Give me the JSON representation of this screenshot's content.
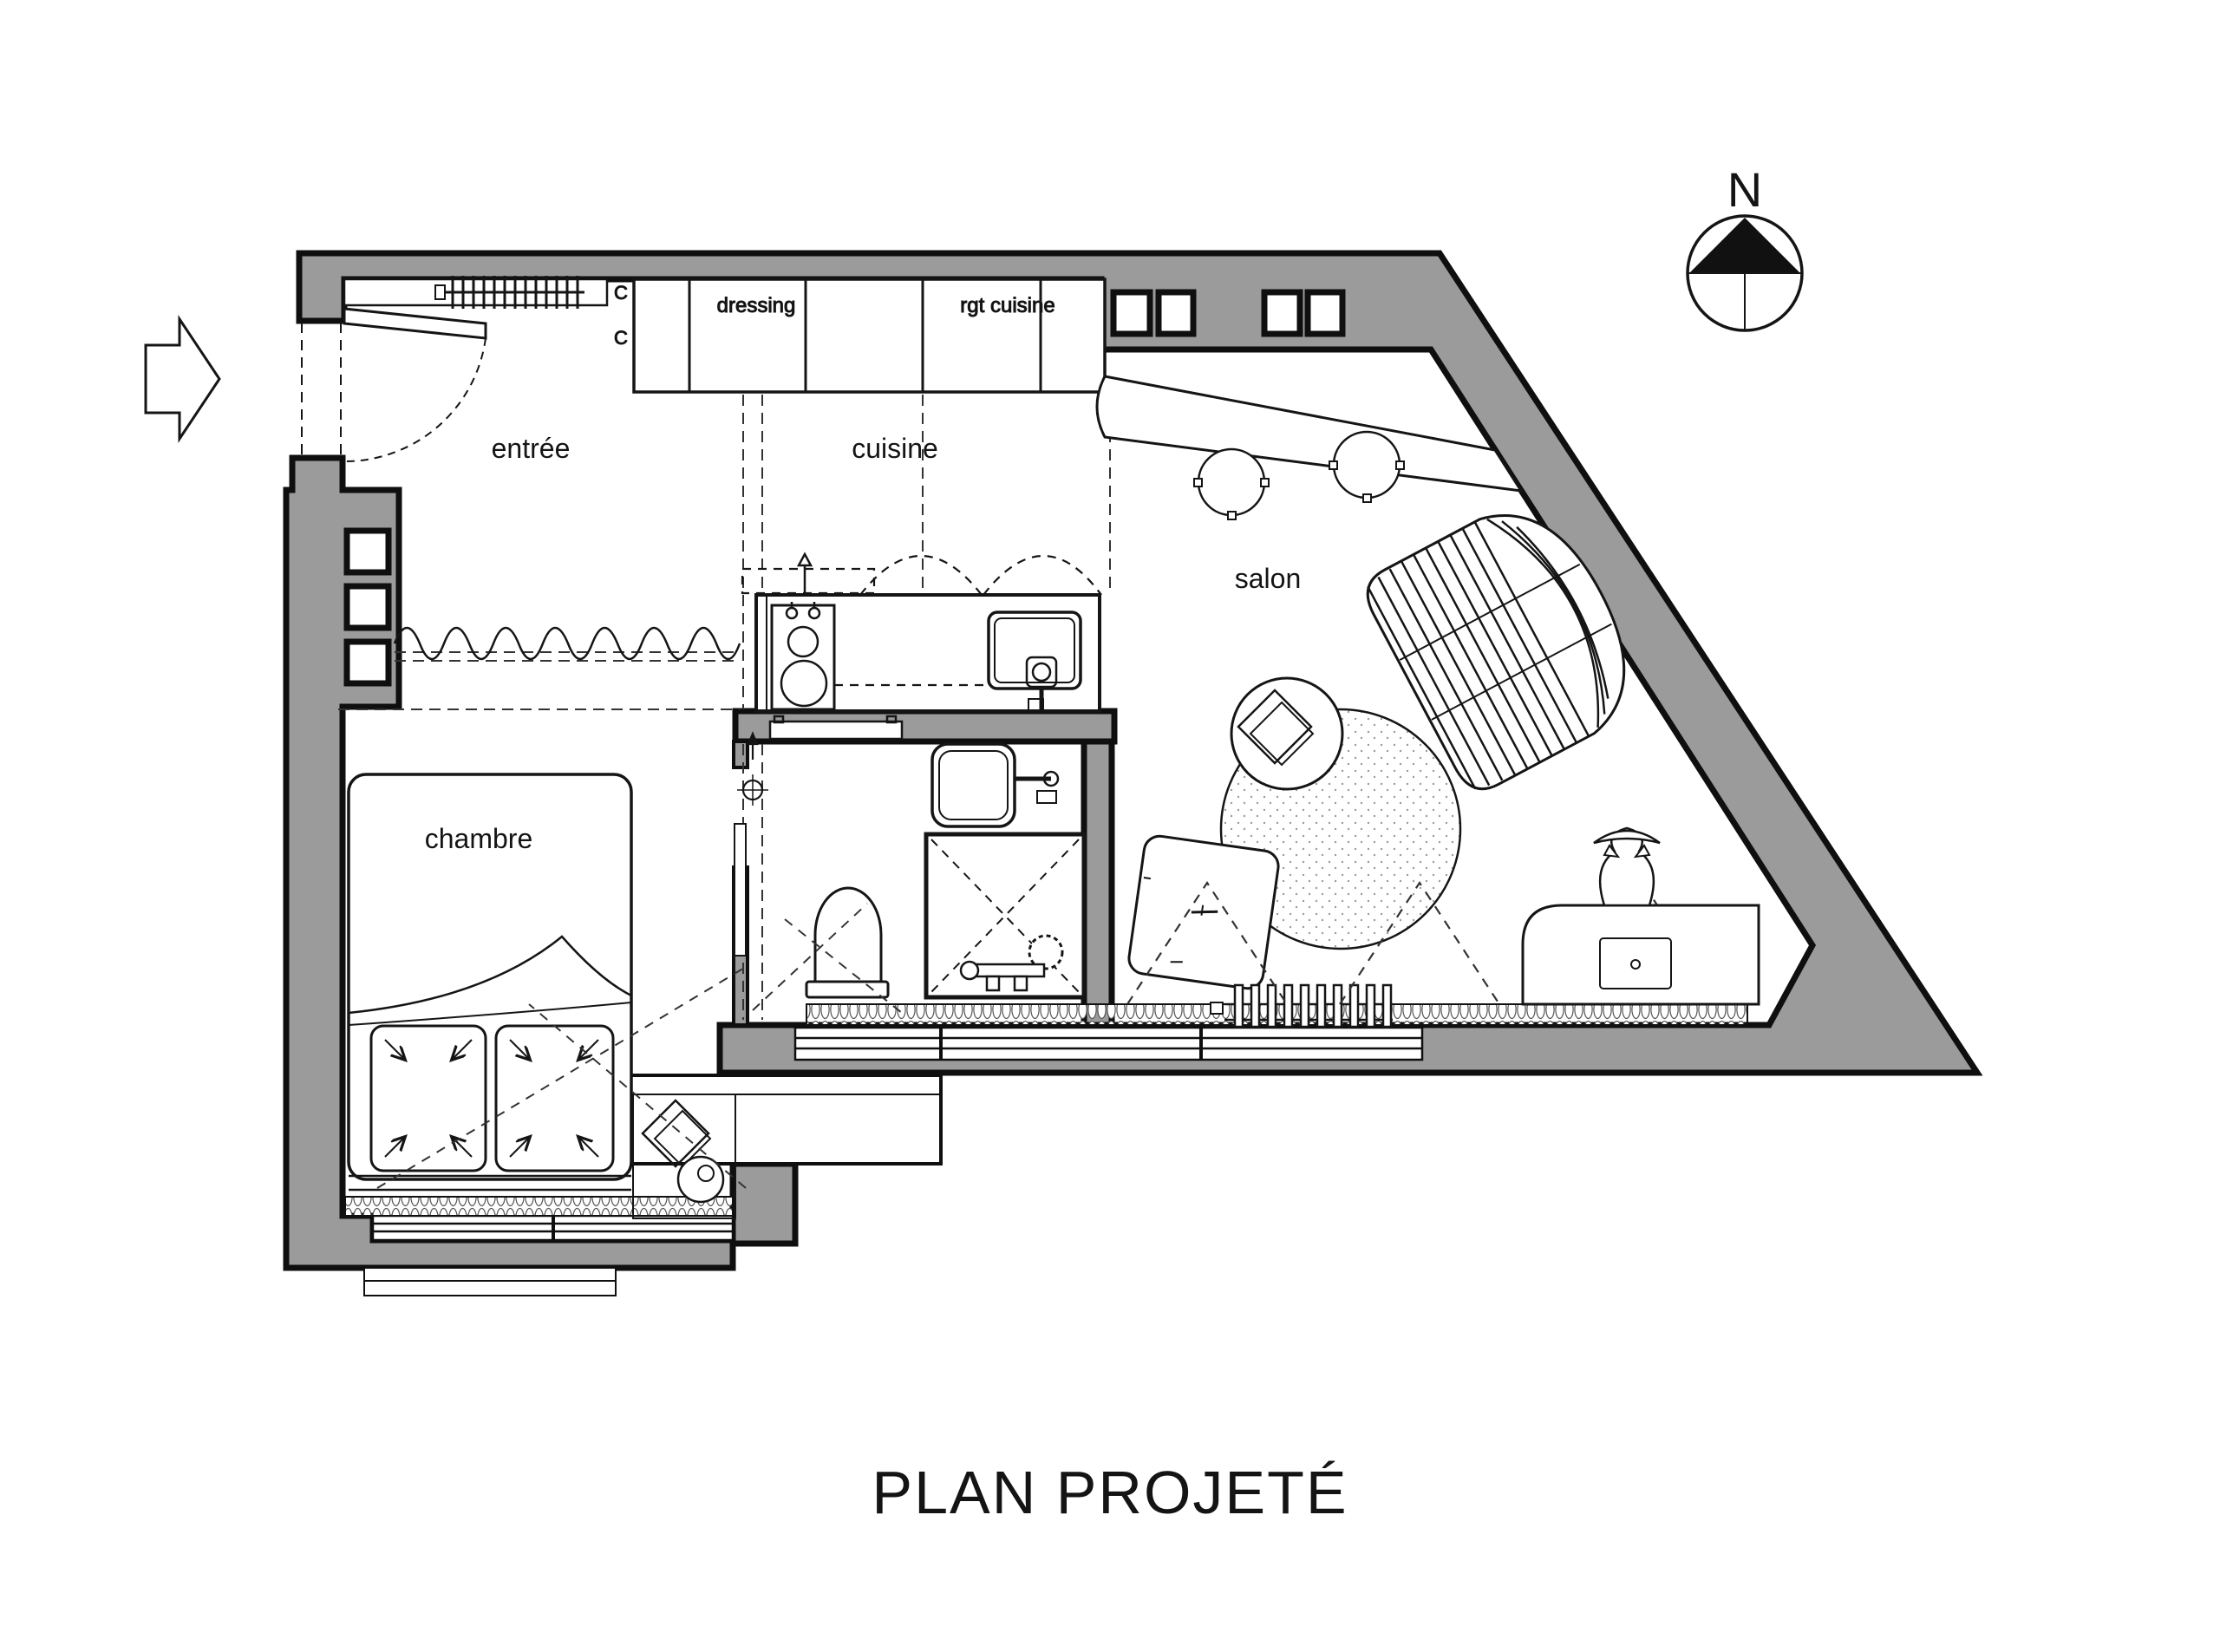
{
  "title": "PLAN PROJETÉ",
  "compass": {
    "north_label": "N"
  },
  "rooms": {
    "entree": "entrée",
    "cuisine": "cuisine",
    "salon": "salon",
    "chambre": "chambre"
  },
  "closets": {
    "dressing": "dressing",
    "rgt_cuisine": "rgt cuisine",
    "mark_top": "C",
    "mark_bottom": "C"
  },
  "colors": {
    "background": "#ffffff",
    "wall_fill": "#9b9b9b",
    "line": "#141414"
  }
}
